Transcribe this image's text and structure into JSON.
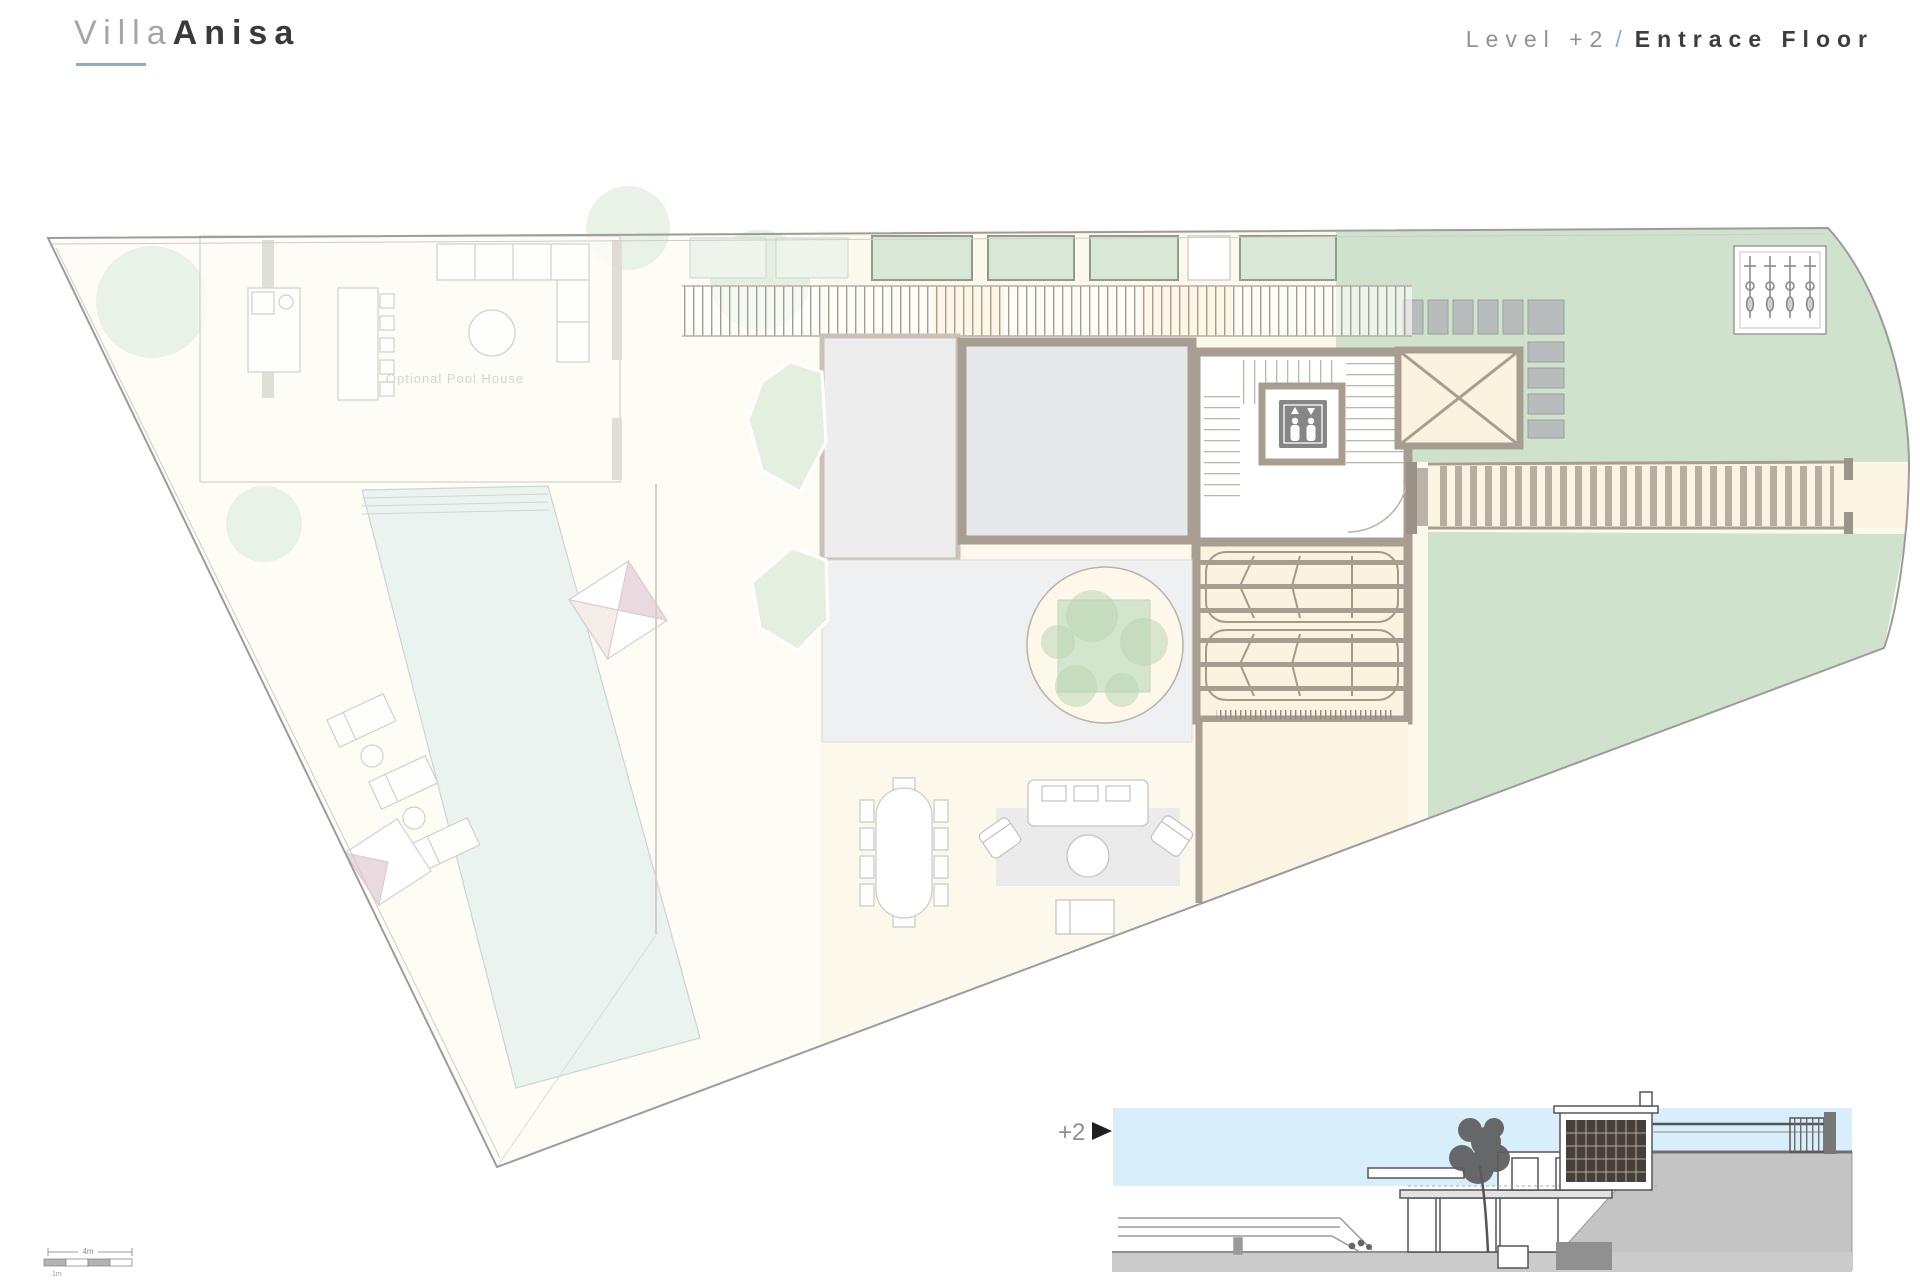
{
  "header": {
    "logo": {
      "light": "Villa",
      "bold": "Anisa"
    },
    "title": {
      "level": "Level +2",
      "separator": "/",
      "name": "Entrace Floor"
    }
  },
  "plan": {
    "pool_house_label": "Optional Pool House",
    "features": {
      "rooms": [
        "pool house",
        "living room",
        "stair hall",
        "elevator",
        "garage",
        "patio",
        "courtyard planter",
        "skylight",
        "driveway",
        "bike parking",
        "pool",
        "sun deck",
        "dining terrace",
        "lounge terrace"
      ],
      "garage_car_spots": "2"
    }
  },
  "section": {
    "marker": "+2"
  },
  "scale_bar": {
    "top_label": "4m",
    "bottom_label": "1m"
  },
  "icons": {
    "elevator": "elevator-icon (two persons with up/down arrows)",
    "section_arrow": "right-pointing triangle",
    "parasol": "pinwheel parasol",
    "car": "car top view",
    "bike": "motorbike top view"
  },
  "colors": {
    "brand_underline": "#8badbc",
    "title_slash_blue": "#7fb3d4",
    "wall": "#a79e91",
    "wall_light": "#c9c2b8",
    "floor_gray": "#e7e8e9",
    "paving": "#fbf3e0",
    "paving_pale": "#fdf8ec",
    "lawn": "#cfe2cb",
    "glass_green": "#d9e8d6",
    "pool": "#e9f2ef",
    "stone": "#b8bcbc",
    "elevator_box": "#868686",
    "section_band": "#d9eefb",
    "terrain_gray": "#c4c4c4",
    "section_line": "#555555"
  }
}
